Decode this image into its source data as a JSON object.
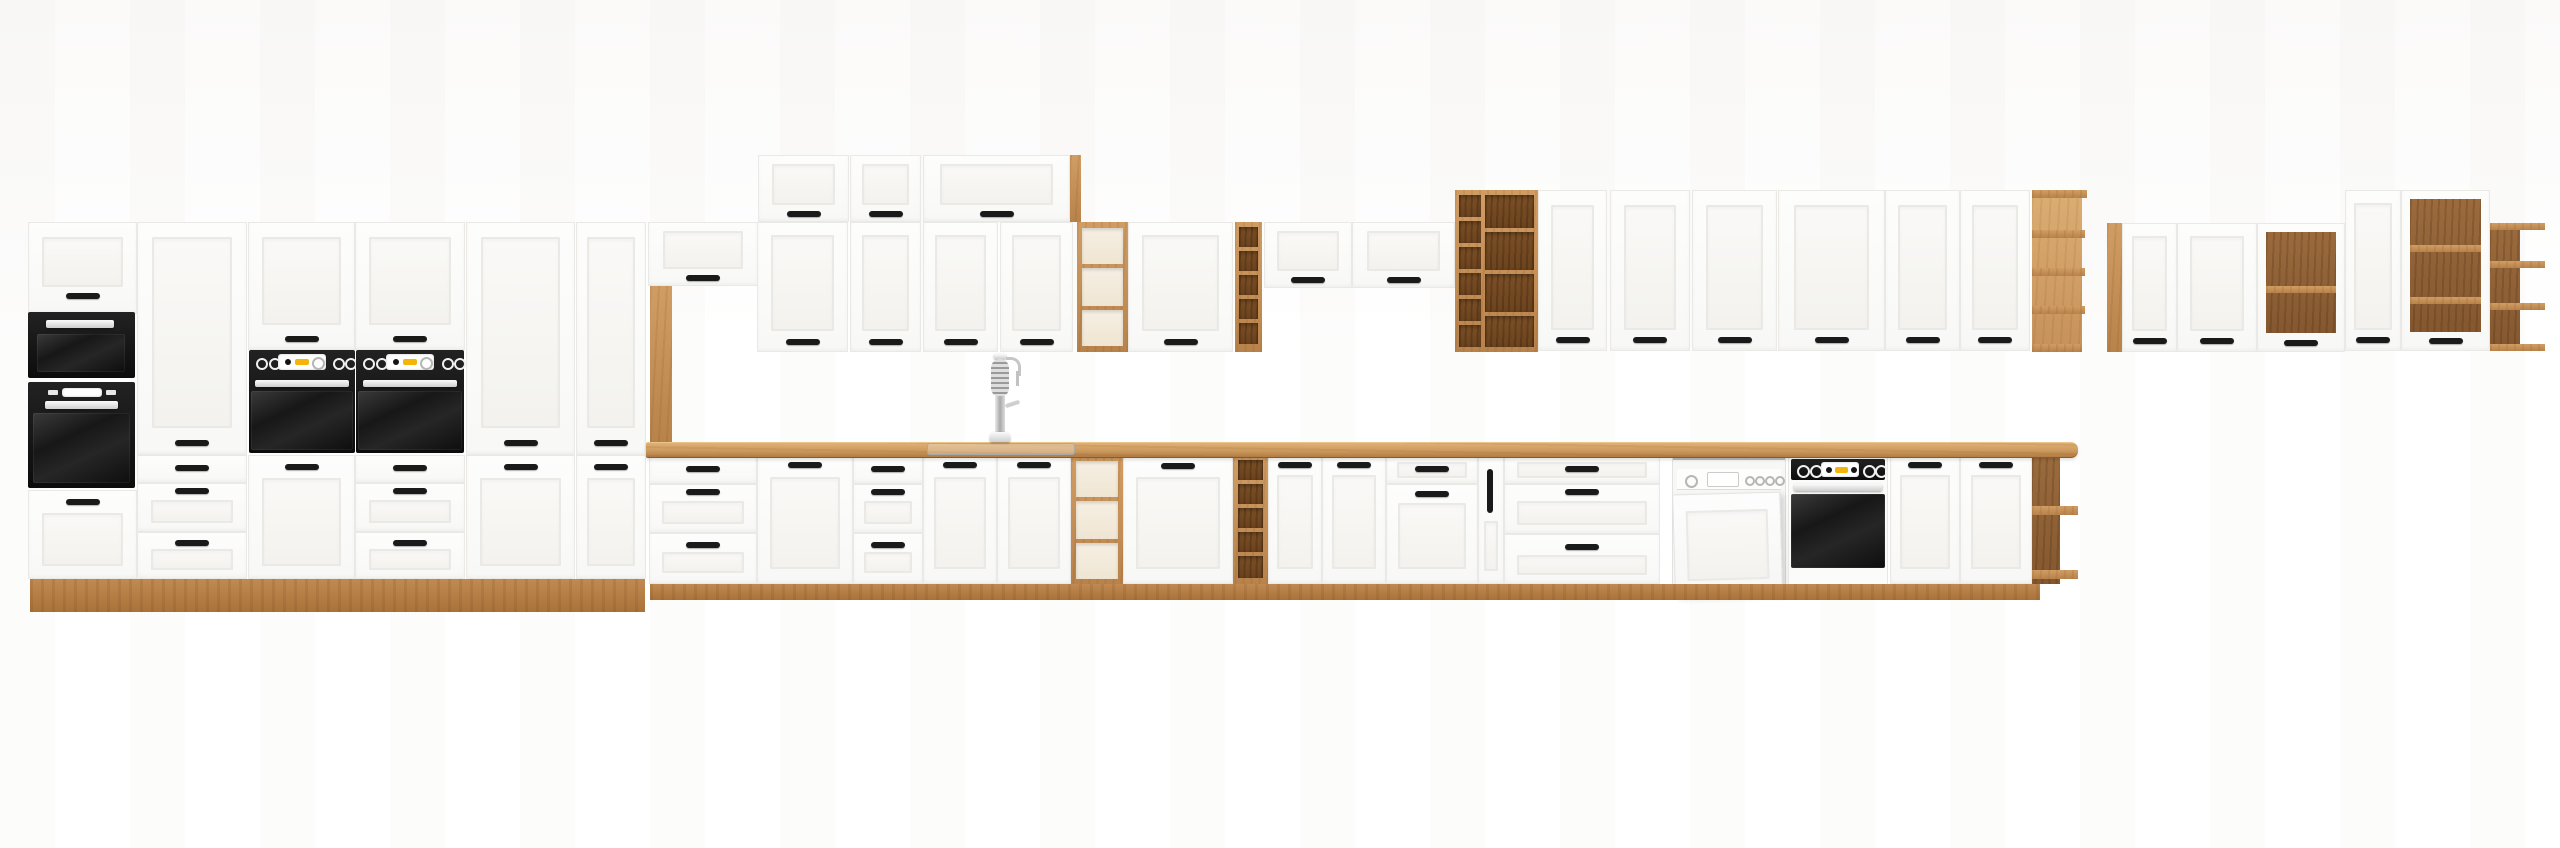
{
  "page": {
    "background": "#ffffff"
  },
  "palette": {
    "cabinet_white": "#fbfbfa",
    "frame_line": "#ebe9e5",
    "wood_oak": "#c08a52",
    "wood_oak_light": "#dcae74",
    "wood_oak_dark": "#8f6136",
    "countertop": "#cc9a5e",
    "handle_black": "#1a1a1a",
    "appliance_black": "#111111",
    "chrome": "#d9d9d9",
    "accent_yellow": "#f4b40a"
  },
  "labels": {
    "kitchen_set": "White and artisan-oak kitchen cabinet set",
    "tall_cabinet": "Tall cabinet",
    "wall_cabinet": "Wall cabinet",
    "base_cabinet": "Base cabinet",
    "drawer_unit": "Drawer unit",
    "open_shelf": "Open oak shelf",
    "bottle_rack": "Bottle rack",
    "display_cabinet": "Display cabinet",
    "countertop": "Oak countertop",
    "plinth": "Oak plinth",
    "microwave": "Built-in microwave",
    "oven": "Built-in oven",
    "dishwasher": "Dishwasher",
    "faucet": "Spring kitchen faucet",
    "sink": "Flush-mount sink",
    "cargo_unit": "Narrow cargo cabinet"
  },
  "appliance_counts": {
    "ovens": 4,
    "microwaves": 1,
    "dishwashers": 1,
    "faucets": 1,
    "sinks": 1
  }
}
